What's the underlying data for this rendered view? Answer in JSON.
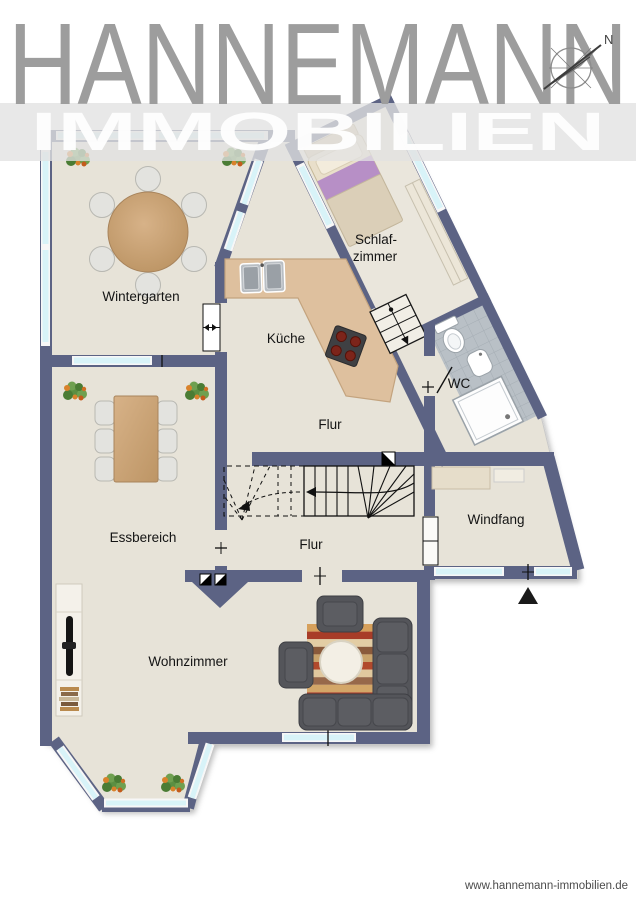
{
  "header": {
    "brand": "HANNEMANN",
    "division": "IMMOBILIEN"
  },
  "compass": {
    "north": "N"
  },
  "rooms": {
    "wintergarten": "Wintergarten",
    "schlafzimmer_l1": "Schlaf-",
    "schlafzimmer_l2": "zimmer",
    "kueche": "Küche",
    "wc": "WC",
    "flur_upper": "Flur",
    "flur_lower": "Flur",
    "essbereich": "Essbereich",
    "windfang": "Windfang",
    "wohnzimmer": "Wohnzimmer"
  },
  "footer": {
    "website": "www.hannemann-immobilien.de"
  },
  "colors": {
    "wall": "#5c6384",
    "floor": "#e7e3d8",
    "window_glass": "#d8f3f8",
    "brand_gray": "#9d9d9d",
    "band_gray": "#e2e2e2",
    "kitchen_counter": "#dec09e",
    "wc_tile": "#b9c0c6"
  }
}
